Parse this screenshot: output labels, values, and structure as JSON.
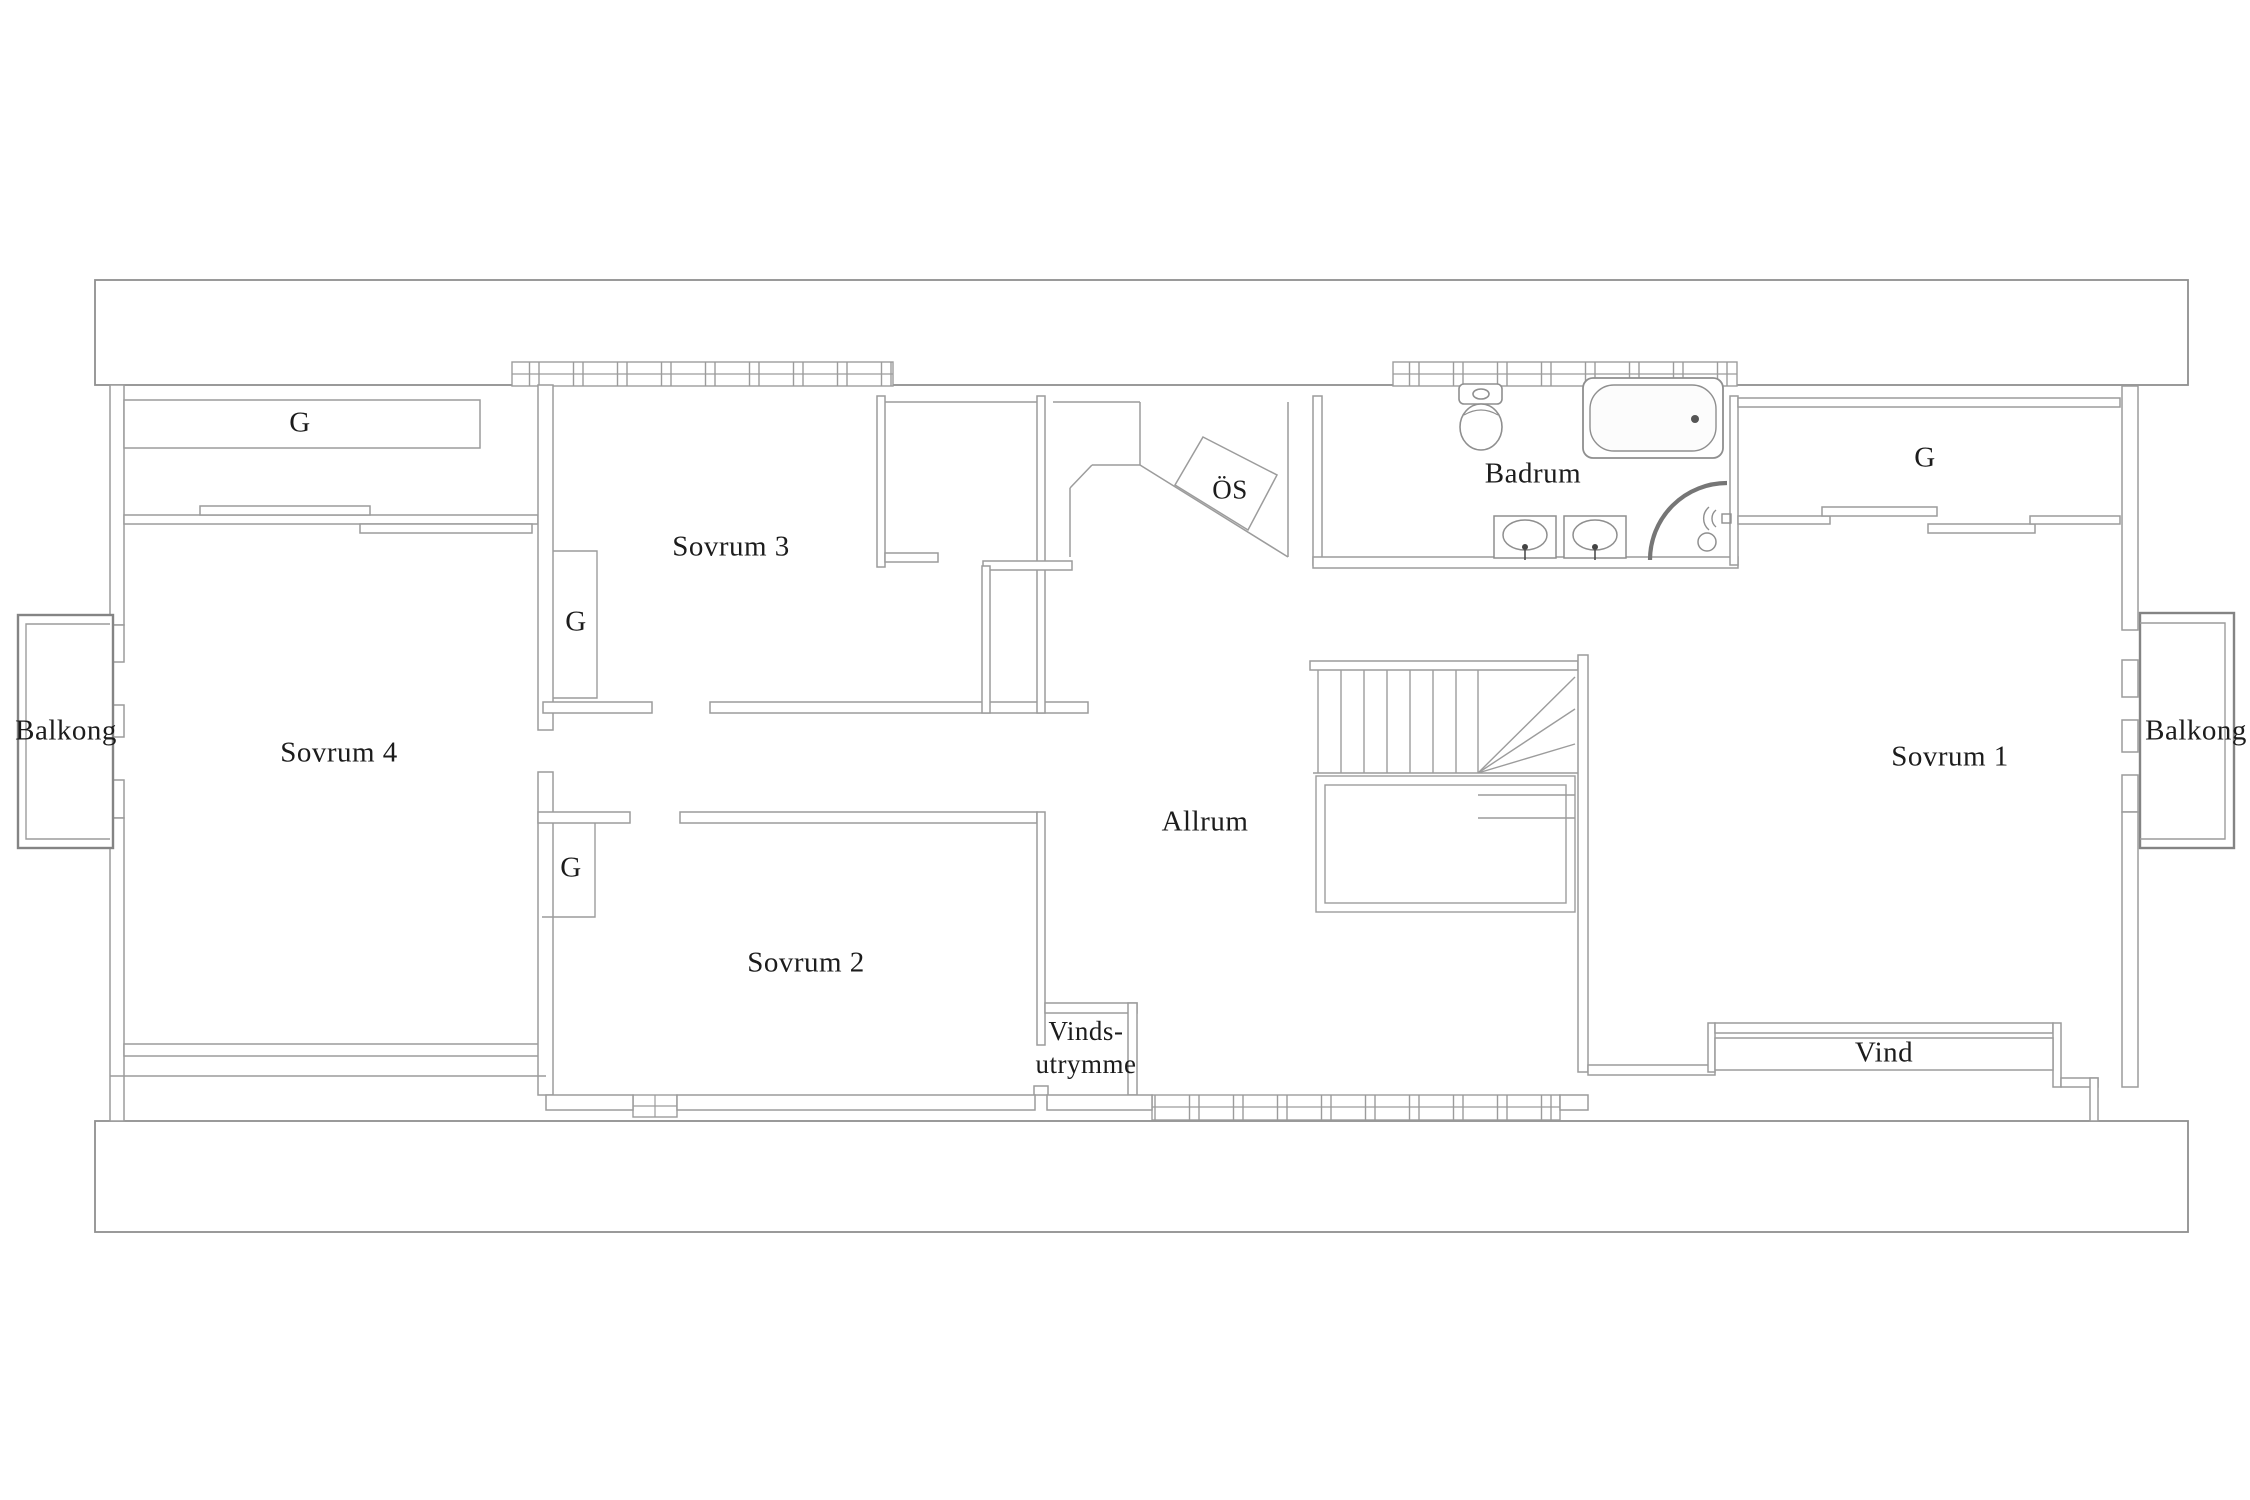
{
  "plan": {
    "rooms": {
      "sovrum1": "Sovrum 1",
      "sovrum2": "Sovrum 2",
      "sovrum3": "Sovrum 3",
      "sovrum4": "Sovrum 4",
      "allrum": "Allrum",
      "badrum": "Badrum",
      "vind": "Vind",
      "vindsutrymme_line1": "Vinds-",
      "vindsutrymme_line2": "utrymme",
      "balkong_left": "Balkong",
      "balkong_right": "Balkong"
    },
    "closets": {
      "sovrum4_closet": "G",
      "sovrum3_closet": "G",
      "sovrum2_closet": "G",
      "sovrum1_closet": "G"
    },
    "fireplace_label": "ÖS",
    "colors": {
      "wall": "#9c9c9c",
      "outline": "#8a8a8a",
      "text": "#1c1c1c",
      "fixture": "#8f8f8f",
      "shower_arc": "#767676",
      "background": "#ffffff"
    }
  }
}
